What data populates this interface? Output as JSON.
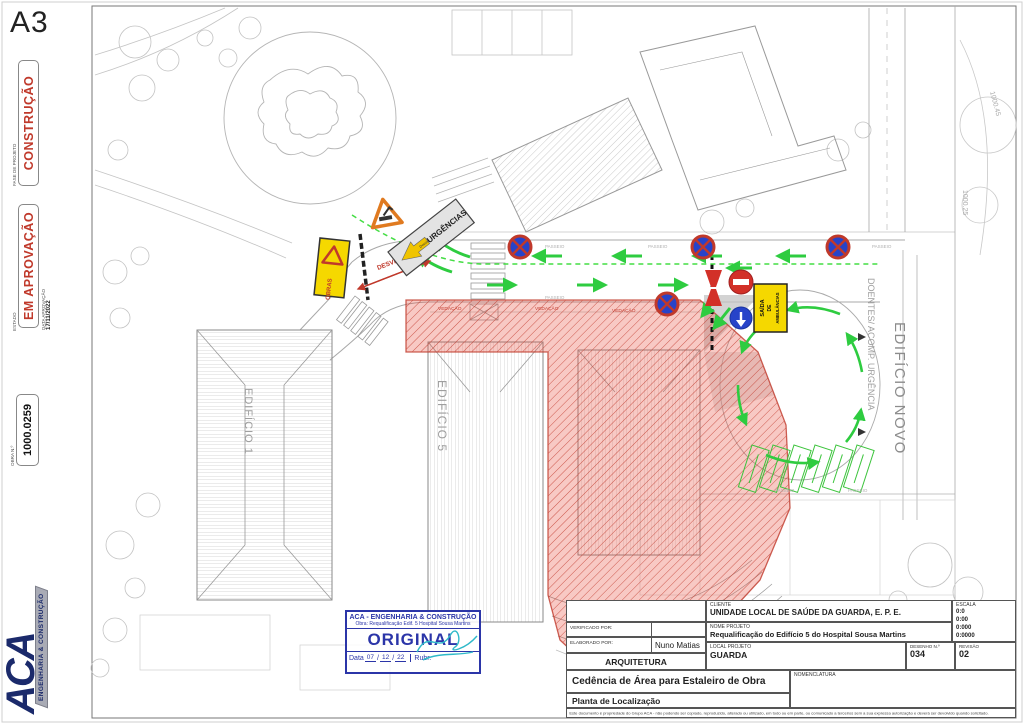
{
  "sheet": {
    "format": "A3",
    "phase": {
      "label": "FASE DE PROJETO",
      "value": "CONSTRUÇÃO"
    },
    "status": {
      "label": "ESTADO",
      "value": "EM APROVAÇÃO"
    },
    "approval": {
      "label": "DATA APROVAÇÃO",
      "value": "17/11/2022"
    },
    "work": {
      "label": "OBRA N.º",
      "value": "1000.0259"
    },
    "logo": {
      "name": "ACA",
      "tagline": "ENGENHARIA & CONSTRUÇÃO"
    }
  },
  "plan": {
    "edificio1": "EDIFÍCIO 1",
    "edificio5": "EDIFÍCIO 5",
    "edificio_novo": "EDIFÍCIO NOVO",
    "route": "DOENTES/ ACOMP. URGÊNCIA",
    "passeio": "PASSEIO",
    "vedacao": "VEDAÇÃO",
    "desvio": "DESVIO",
    "contour_a": "1000.45",
    "contour_b": "1000.25",
    "signs": {
      "urgencias": "URGÊNCIAS",
      "urgencias_tag": "Desvio",
      "obras": "OBRAS",
      "ambulancias": {
        "l1": "SAÍDA",
        "l2": "DE",
        "l3": "AMBULÂNCIAS"
      }
    }
  },
  "stamp": {
    "company": "ACA - ENGENHARIA & CONSTRUÇÃO",
    "obra": "Obra: Requalificação Edif. 5 Hospital Sousa Martins",
    "original": "ORIGINAL",
    "data_label": "Data",
    "day": "07",
    "month": "12",
    "year": "22",
    "sep": "/",
    "rubr_label": "Rubr."
  },
  "titleblock": {
    "cliente_label": "CLIENTE",
    "cliente": "UNIDADE LOCAL DE SAÚDE DA GUARDA, E. P. E.",
    "nome_projeto_label": "NOME PROJETO",
    "nome_projeto": "Requalificação do Edifício 5 do Hospital Sousa Martins",
    "local_label": "LOCAL PROJETO",
    "local": "GUARDA",
    "verificado_label": "VERIFICADO POR:",
    "elaborado_label": "ELABORADO POR:",
    "elaborado": "Nuno Matias",
    "disciplina": "ARQUITETURA",
    "escala_label": "ESCALA",
    "escalas": [
      "0:0",
      "0:00",
      "0:000",
      "0:0000"
    ],
    "desenho_label": "DESENHO N.º",
    "desenho": "034",
    "revisao_label": "REVISÃO",
    "revisao": "02",
    "assunto": "Cedência de Área para Estaleiro de Obra",
    "titulo": "Planta de Localização",
    "nomenclatura_label": "NOMENCLATURA",
    "disclaimer": "Este documento é propriedade do Grupo ACA - não podendo ser copiado, reproduzido, alterado ou utilizado, em todo ou em parte, ou comunicado a terceiros sem a sua expressa autorização e deverá ser devolvido quando solicitado."
  },
  "colors": {
    "accent_red": "#c0392b",
    "stamp_blue": "#2b35a8",
    "signal_green": "#2ecc40",
    "sign_yellow": "#f5d800",
    "logo_navy": "#1b2a6b"
  }
}
